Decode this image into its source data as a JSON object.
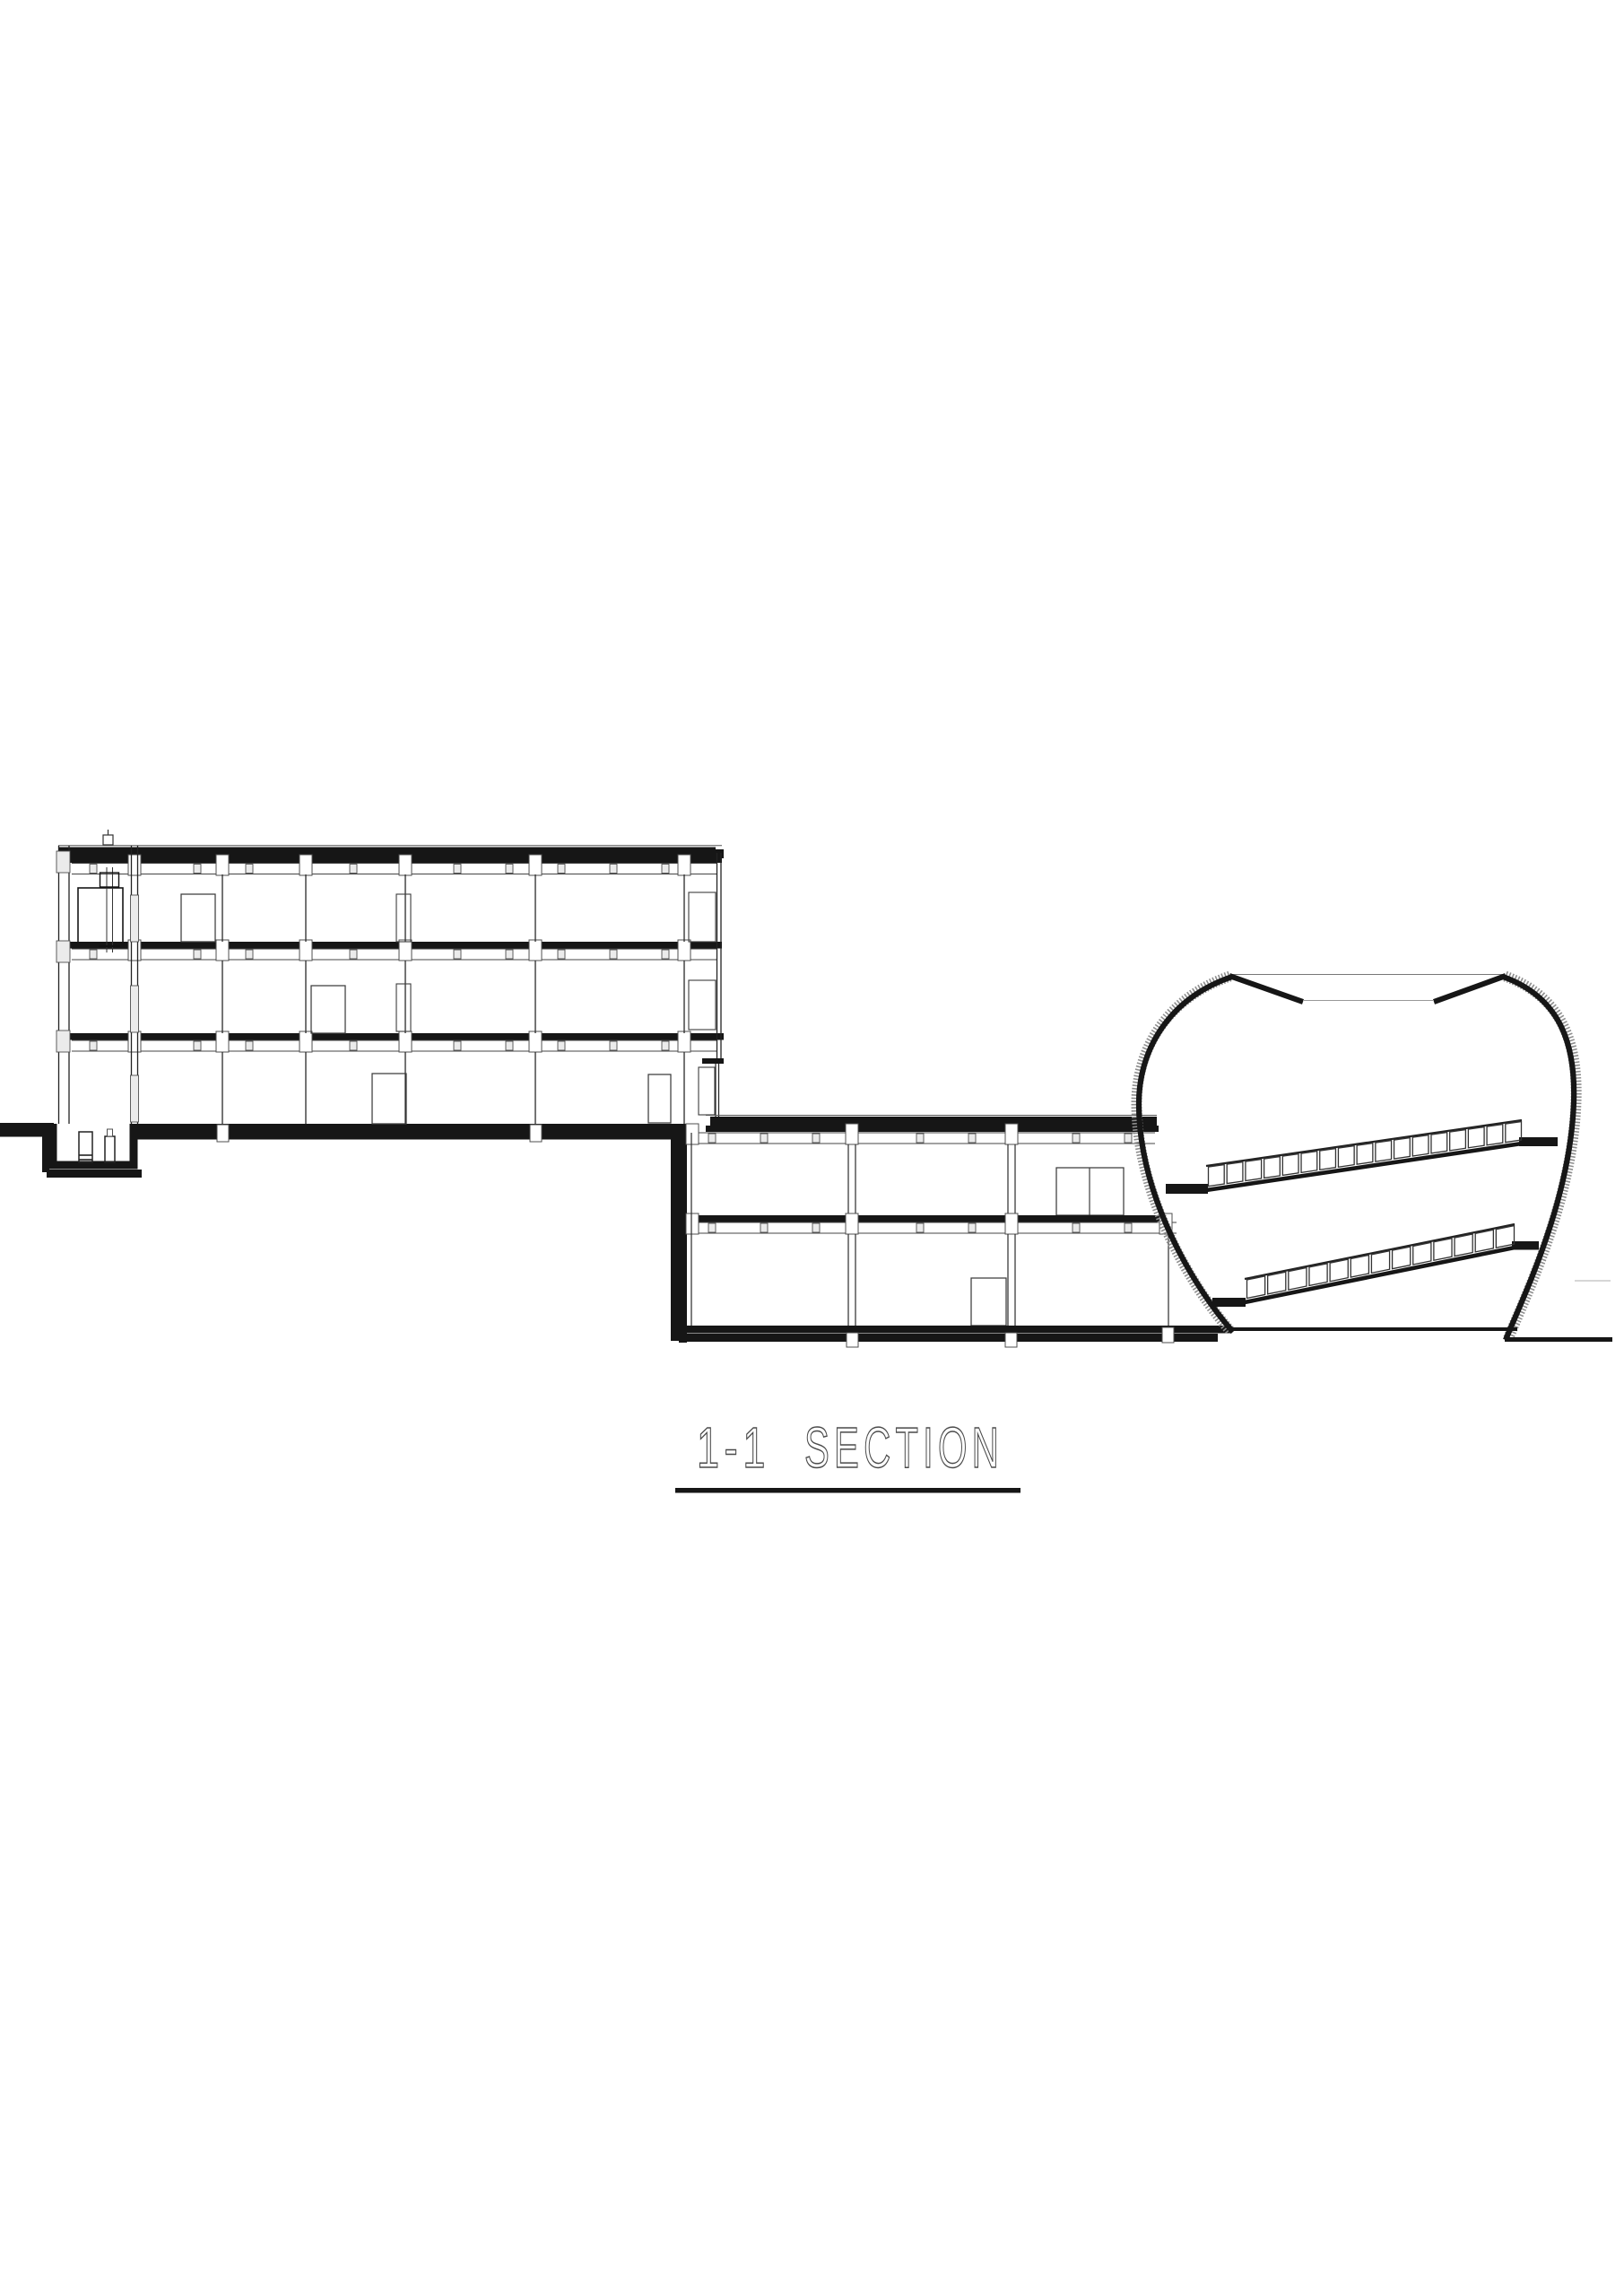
{
  "title": {
    "label_left": "1-1",
    "label_right": "SECTION"
  },
  "colors": {
    "ink": "#161616",
    "line_gray": "#4f4f4f",
    "block_fill": "#ebebeb",
    "shell_texture": "#8e8e8e",
    "faint": "#c9c9c9",
    "title_text": "#4a4a4a",
    "background": "#ffffff"
  }
}
